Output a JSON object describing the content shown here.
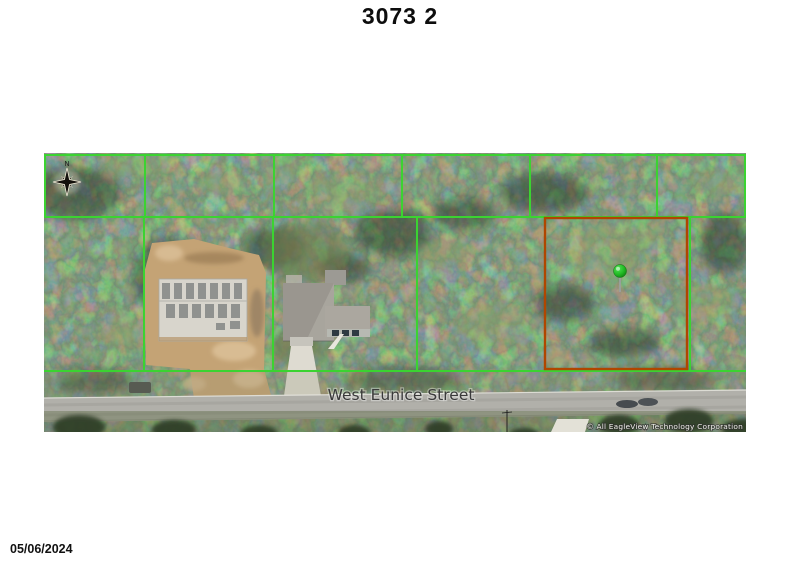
{
  "page": {
    "title": "3073 2",
    "date": "05/06/2024"
  },
  "map": {
    "street_label": "West Eunice Street",
    "copyright": "© All EagleView Technology Corporation",
    "compass_letter": "N",
    "colors": {
      "parcel_line": "#3bd331",
      "subject_parcel_outline": "#b04600",
      "location_marker": "#2fc12f"
    }
  }
}
